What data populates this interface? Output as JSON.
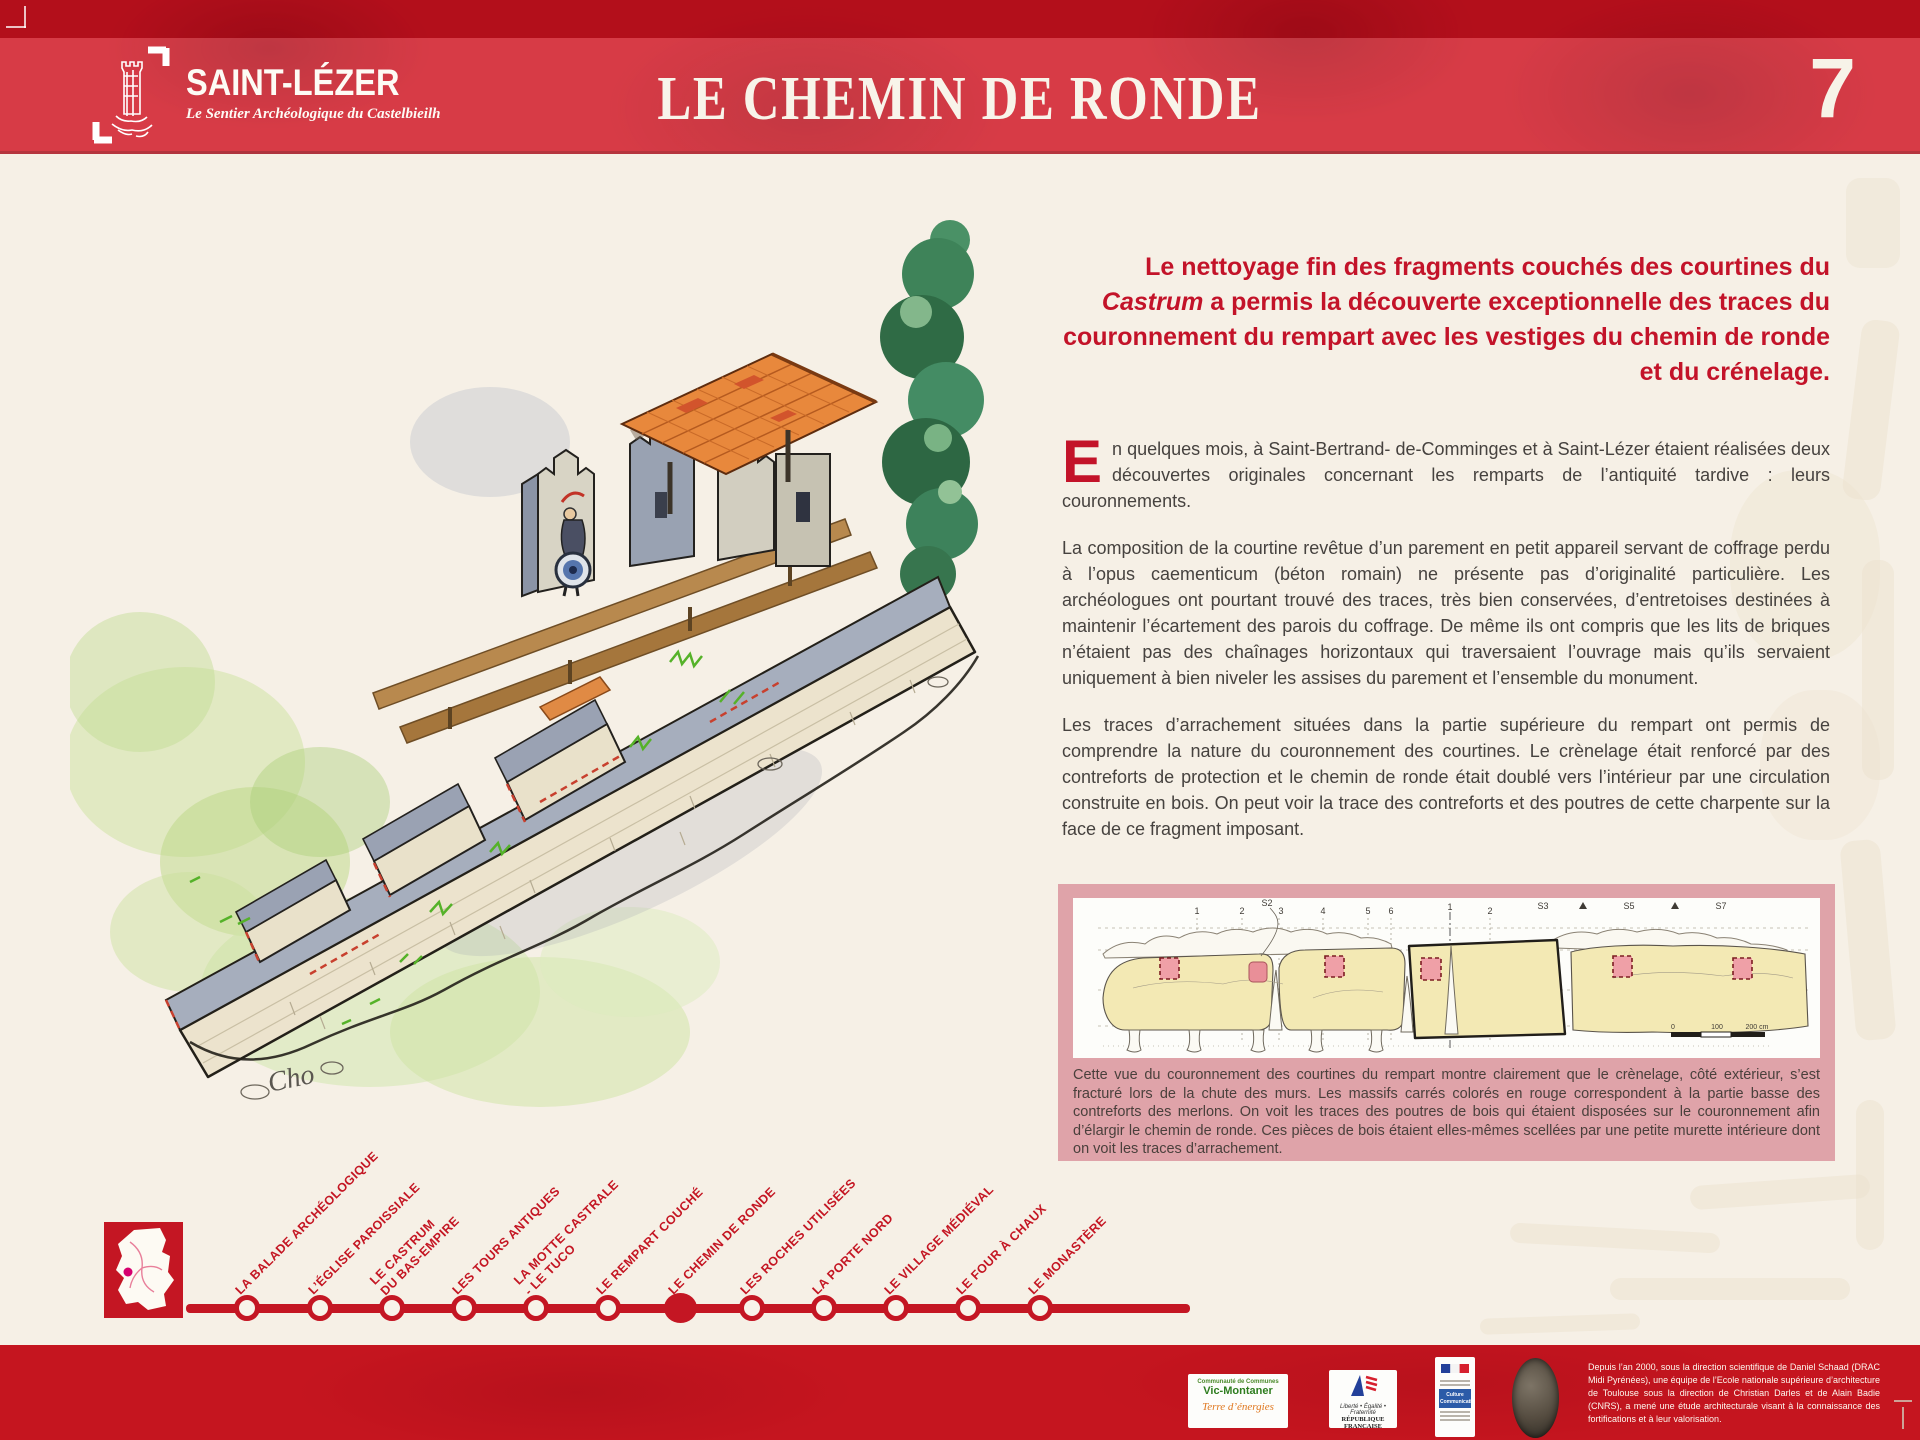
{
  "header": {
    "logo": {
      "title": "SAINT-LÉZER",
      "subtitle": "Le Sentier Archéologique du Castelbieilh"
    },
    "title": "LE CHEMIN DE RONDE",
    "panel_number": "7"
  },
  "intro": {
    "part1": "Le nettoyage fin des fragments couchés des courtines du ",
    "italic": "Castrum",
    "part2": " a permis la découverte exceptionnelle des traces du couronnement du rempart avec les vestiges du chemin de ronde et du crénelage."
  },
  "article": {
    "dropcap": "E",
    "p1_rest": "n quelques mois, à Saint-Bertrand- de-Comminges et à Saint-Lézer étaient réalisées deux découvertes originales concernant les remparts de l’antiquité tardive : leurs couronnements.",
    "p2": "La composition de la courtine revêtue d’un parement en petit appareil servant de coffrage perdu à l’opus caementicum (béton romain) ne présente pas d’originalité particulière. Les archéologues ont pourtant trouvé des traces, très bien conservées, d’entretoises destinées à maintenir l’écartement des parois du coffrage. De même ils ont compris que les lits de briques n’étaient pas des chaînages horizontaux qui traversaient l’ouvrage mais qu’ils servaient uniquement à bien niveler les assises du parement et l’ensemble du monument.",
    "p3": "Les traces d’arrachement situées dans la partie supérieure du rempart ont permis de comprendre la nature du couronnement des courtines. Le crènelage était renforcé par des contreforts de protection et le chemin de ronde était doublé vers l’intérieur par une circulation construite en bois. On peut voir la trace des contreforts et des poutres de cette charpente sur la face de ce fragment imposant."
  },
  "figure": {
    "caption": "Cette vue du couronnement des courtines du rempart montre clairement que le crènelage, côté extérieur, s’est fracturé lors de la chute des murs. Les massifs carrés colorés en rouge correspondent à la partie basse des contreforts des merlons. On voit les traces des poutres de bois qui étaient disposées sur le couronnement afin d’élargir le chemin de ronde. Ces pièces de bois étaient elles-mêmes scellées par une petite murette intérieure dont on voit les traces d’arrachement.",
    "ticks": [
      "1",
      "2",
      "S2",
      "3",
      "4",
      "5",
      "6",
      "1",
      "2",
      "S3",
      "S5",
      "S7"
    ],
    "scale": [
      "0",
      "100",
      "200 cm"
    ]
  },
  "illustration": {
    "signature": "Cho"
  },
  "timeline": {
    "stops": [
      {
        "label": "LA BALADE ARCHÉOLOGIQUE",
        "current": false
      },
      {
        "label": "L’ÉGLISE PAROISSIALE",
        "current": false
      },
      {
        "label": "LE CASTRUM\nDU BAS-EMPIRE",
        "current": false
      },
      {
        "label": "LES TOURS ANTIQUES",
        "current": false
      },
      {
        "label": "LA MOTTE CASTRALE\n- LE TUCO",
        "current": false
      },
      {
        "label": "LE REMPART COUCHÉ",
        "current": false
      },
      {
        "label": "LE CHEMIN DE RONDE",
        "current": true
      },
      {
        "label": "LES ROCHES UTILISÉES",
        "current": false
      },
      {
        "label": "LA PORTE NORD",
        "current": false
      },
      {
        "label": "LE VILLAGE MÉDIÉVAL",
        "current": false
      },
      {
        "label": "LE FOUR À CHAUX",
        "current": false
      },
      {
        "label": "LE MONASTÈRE",
        "current": false
      }
    ]
  },
  "footer": {
    "logos": {
      "vic_montaner": {
        "line1": "Communauté de Communes",
        "line2": "Vic-Montaner",
        "line3": "Terre d’énergies"
      },
      "republique": {
        "motto": "Liberté • Égalité • Fraternité",
        "name": "RÉPUBLIQUE FRANÇAISE"
      },
      "culture": {
        "label": "Culture Communication"
      }
    },
    "credits": "Depuis l’an 2000, sous la direction scientifique de Daniel Schaad (DRAC Midi Pyrénées), une équipe de l’Ecole nationale supérieure d’architecture de Toulouse sous la direction de Christian Darles et de Alain Badie (CNRS), a mené une étude architecturale visant à la connaissance des fortifications et à leur valorisation."
  },
  "colors": {
    "header_red": "#cf1421",
    "accent_red": "#c31329",
    "timeline_red": "#c41623",
    "figure_pink": "#dfa3a9",
    "diagram_yellow": "#f3e9b4",
    "diagram_square_pink": "#efa0a7",
    "footer_red": "#c5151f",
    "magenta_dot": "#d6006e",
    "background_cream": "#f6f0e6"
  }
}
